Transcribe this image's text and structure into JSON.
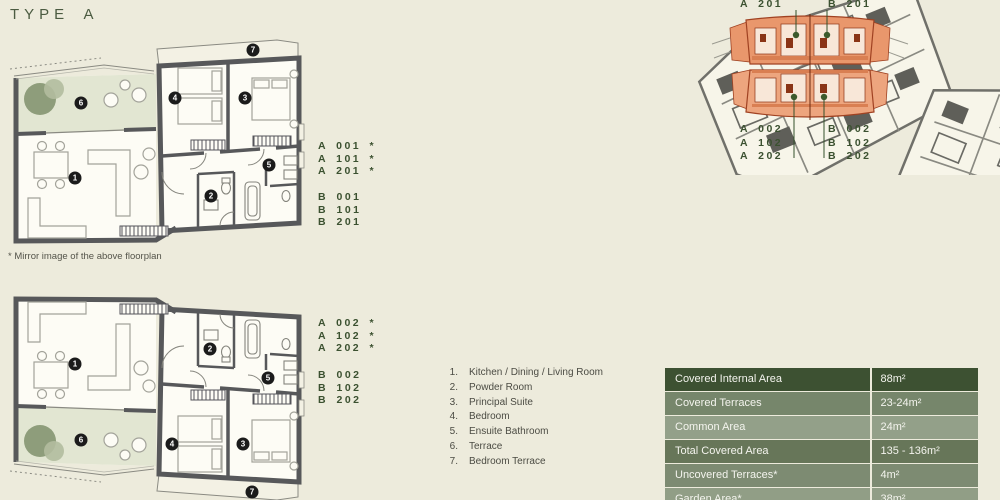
{
  "page": {
    "title": "TYPE A",
    "mirror_note": "* Mirror image of the above floorplan"
  },
  "markers": [
    "1",
    "2",
    "3",
    "4",
    "5",
    "6",
    "7"
  ],
  "plans": {
    "upper": {
      "a_units": [
        "A 001 *",
        "A 101 *",
        "A 201 *"
      ],
      "b_units": [
        "B 001",
        "B 101",
        "B 201"
      ]
    },
    "lower": {
      "a_units": [
        "A 002 *",
        "A 102 *",
        "A 202 *"
      ],
      "b_units": [
        "B 002",
        "B 102",
        "B 202"
      ]
    }
  },
  "legend": {
    "items": [
      {
        "num": "1.",
        "label": "Kitchen / Dining / Living Room"
      },
      {
        "num": "2.",
        "label": "Powder Room"
      },
      {
        "num": "3.",
        "label": "Principal Suite"
      },
      {
        "num": "4.",
        "label": "Bedroom"
      },
      {
        "num": "5.",
        "label": "Ensuite Bathroom"
      },
      {
        "num": "6.",
        "label": "Terrace"
      },
      {
        "num": "7.",
        "label": "Bedroom Terrace"
      }
    ]
  },
  "keyplan": {
    "top_labels": [
      "A 201",
      "B 201"
    ],
    "bottom_left_labels": [
      "A 002",
      "A 102",
      "A 202"
    ],
    "bottom_right_labels": [
      "B 002",
      "B 102",
      "B 202"
    ]
  },
  "area_table": {
    "rows": [
      {
        "label": "Covered Internal Area",
        "value": "88m²"
      },
      {
        "label": "Covered Terraces",
        "value": "23-24m²"
      },
      {
        "label": "Common Area",
        "value": "24m²"
      },
      {
        "label": "Total Covered Area",
        "value": "135 - 136m²"
      },
      {
        "label": "Uncovered Terraces*",
        "value": "4m²"
      },
      {
        "label": "Garden Area*",
        "value": "38m²"
      }
    ]
  },
  "colors": {
    "background": "#edebdc",
    "accent_green_text": "#3b5130",
    "wall_gray": "#57585a",
    "terrace_green": "#e2e6d2",
    "highlight_orange": "#e9976c",
    "table_row_dark": "#3d5132",
    "table_row_medium": "#76866b",
    "table_row_light": "#93a089"
  }
}
